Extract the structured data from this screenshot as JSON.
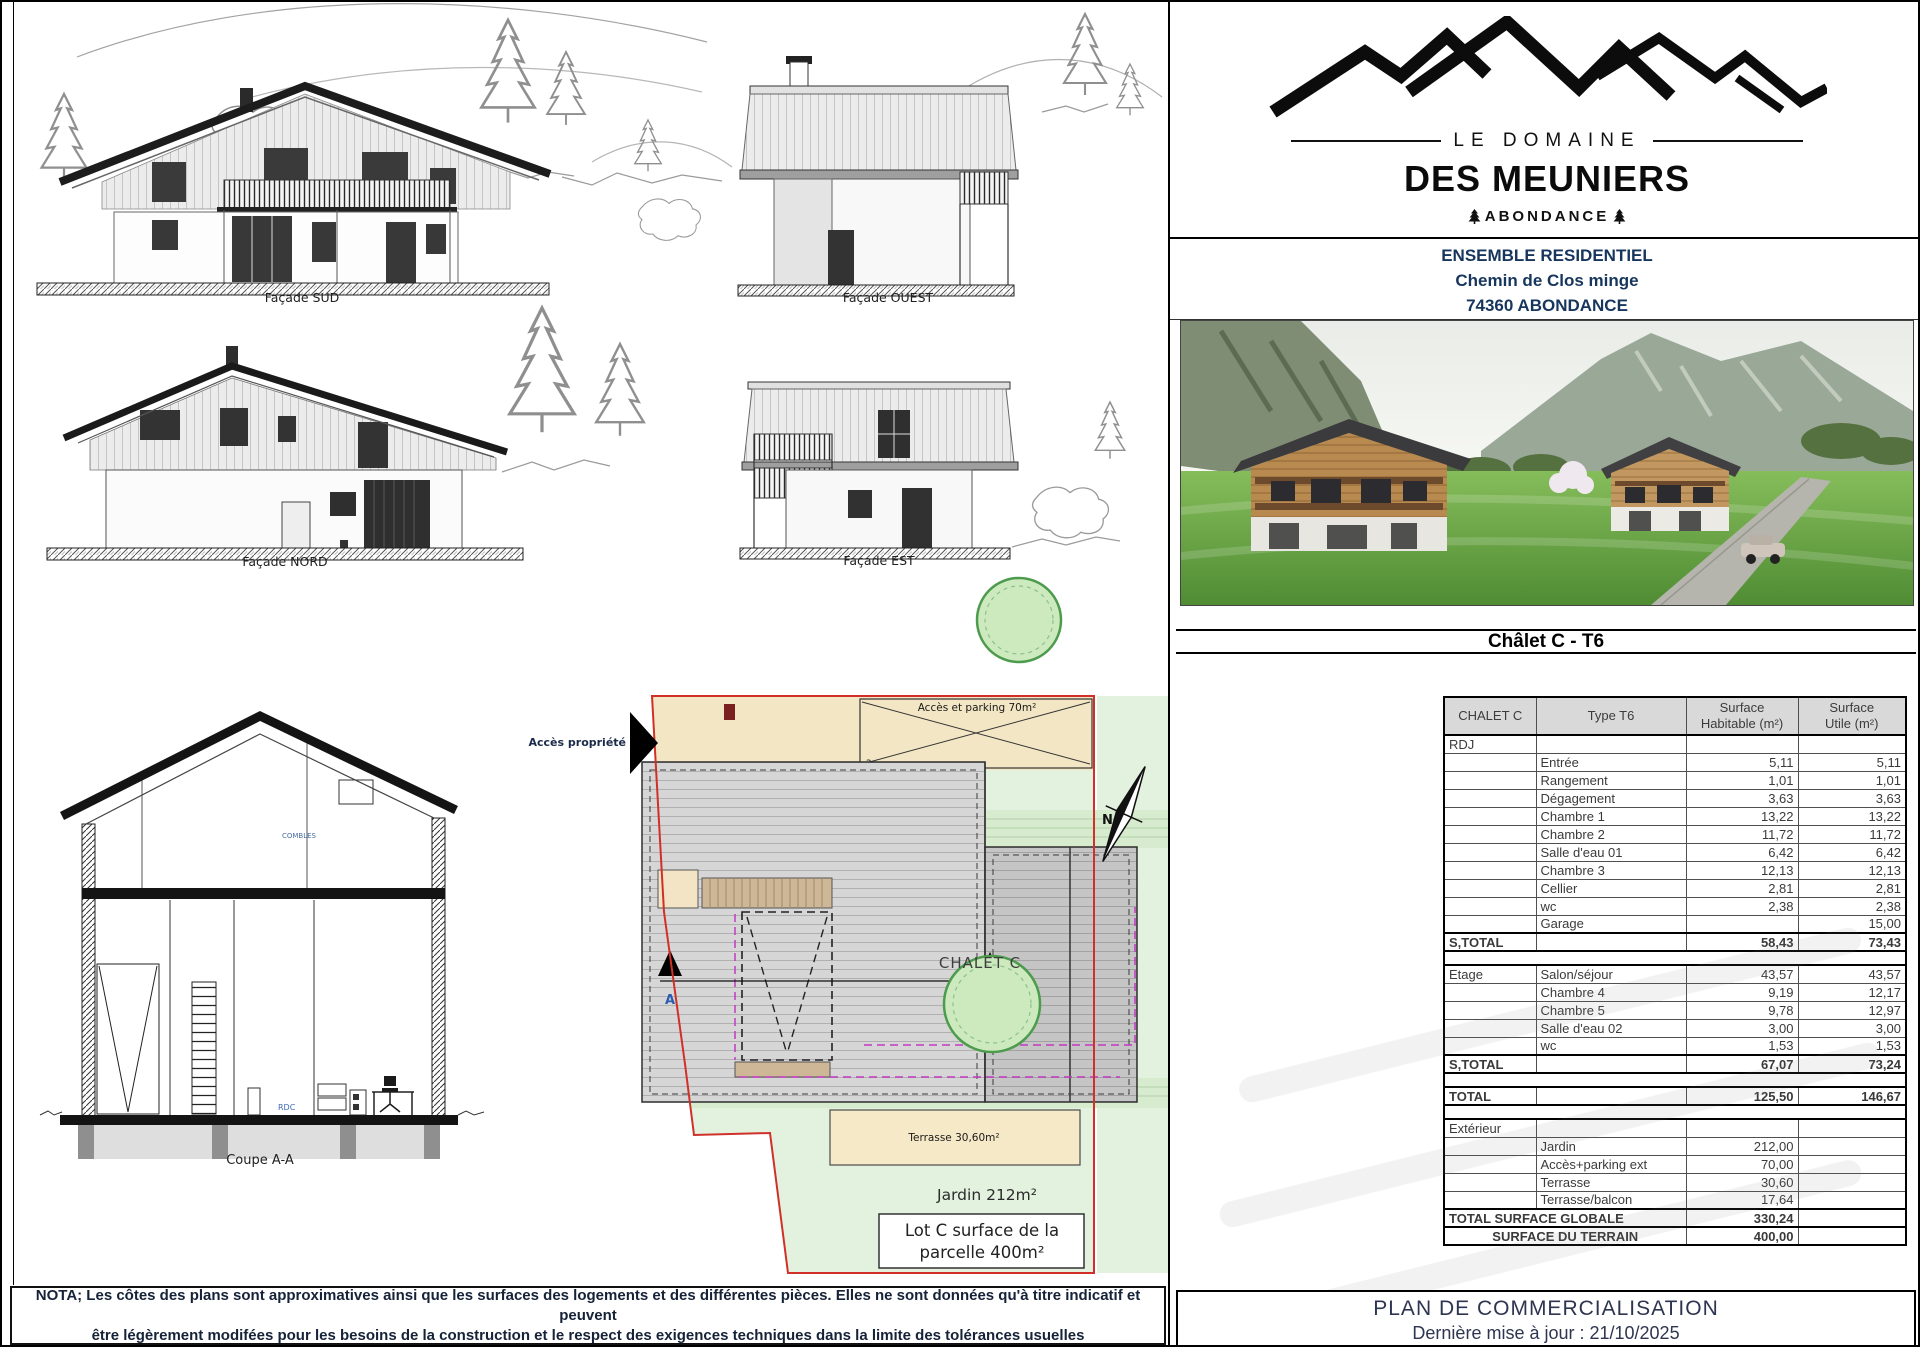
{
  "page": {
    "nota_line1": "NOTA; Les côtes des plans sont approximatives ainsi que les surfaces des logements et des différentes pièces. Elles ne sont données qu'à titre indicatif et peuvent",
    "nota_line2": "être légèrement modifées pour les besoins de la construction et le respect des exigences techniques dans la limite des tolérances usuelles"
  },
  "drawings": {
    "facade_sud_label": "Façade SUD",
    "facade_ouest_label": "Façade OUEST",
    "facade_nord_label": "Façade NORD",
    "facade_est_label": "Façade EST",
    "coupe_label": "Coupe A-A",
    "combles_label": "COMBLES",
    "rdc_label": "RDC"
  },
  "siteplan": {
    "chalet_label": "CHALET C",
    "acces_parking_label": "Accès et parking 70m²",
    "acces_propriete_label": "Accès propriété",
    "terrasse_label": "Terrasse 30,60m²",
    "jardin_label": "Jardin 212m²",
    "lot_line1": "Lot C surface de la",
    "lot_line2": "parcelle 400m²",
    "section_marker_left": "A",
    "section_marker_right": "A",
    "parking_number": "2",
    "north_label": "N"
  },
  "panel": {
    "brand": {
      "top": "LE DOMAINE",
      "name": "DES MEUNIERS",
      "location": "ABONDANCE"
    },
    "address": {
      "line1": "ENSEMBLE RESIDENTIEL",
      "line2": "Chemin de Clos minge",
      "line3": "74360 ABONDANCE"
    },
    "unit_title": "Châlet C - T6",
    "table": {
      "headers": {
        "col1": "CHALET C",
        "col2": "Type T6",
        "col3": "Surface\nHabitable (m²)",
        "col4": "Surface\nUtile (m²)"
      },
      "rows": [
        {
          "type": "section",
          "c1": "RDJ",
          "c2": "",
          "hab": "",
          "utile": ""
        },
        {
          "type": "row",
          "c1": "",
          "c2": "Entrée",
          "hab": "5,11",
          "utile": "5,11"
        },
        {
          "type": "row",
          "c1": "",
          "c2": "Rangement",
          "hab": "1,01",
          "utile": "1,01"
        },
        {
          "type": "row",
          "c1": "",
          "c2": "Dégagement",
          "hab": "3,63",
          "utile": "3,63"
        },
        {
          "type": "row",
          "c1": "",
          "c2": "Chambre 1",
          "hab": "13,22",
          "utile": "13,22"
        },
        {
          "type": "row",
          "c1": "",
          "c2": "Chambre 2",
          "hab": "11,72",
          "utile": "11,72"
        },
        {
          "type": "row",
          "c1": "",
          "c2": "Salle d'eau 01",
          "hab": "6,42",
          "utile": "6,42"
        },
        {
          "type": "row",
          "c1": "",
          "c2": "Chambre 3",
          "hab": "12,13",
          "utile": "12,13"
        },
        {
          "type": "row",
          "c1": "",
          "c2": "Cellier",
          "hab": "2,81",
          "utile": "2,81"
        },
        {
          "type": "row",
          "c1": "",
          "c2": "wc",
          "hab": "2,38",
          "utile": "2,38"
        },
        {
          "type": "row",
          "c1": "",
          "c2": "Garage",
          "hab": "",
          "utile": "15,00"
        },
        {
          "type": "subtotal",
          "c1": "S,TOTAL",
          "c2": "",
          "hab": "58,43",
          "utile": "73,43"
        },
        {
          "type": "gap"
        },
        {
          "type": "row2",
          "c1": "Etage",
          "c2": "Salon/séjour",
          "hab": "43,57",
          "utile": "43,57"
        },
        {
          "type": "row",
          "c1": "",
          "c2": "Chambre 4",
          "hab": "9,19",
          "utile": "12,17"
        },
        {
          "type": "row",
          "c1": "",
          "c2": "Chambre 5",
          "hab": "9,78",
          "utile": "12,97"
        },
        {
          "type": "row",
          "c1": "",
          "c2": "Salle d'eau 02",
          "hab": "3,00",
          "utile": "3,00"
        },
        {
          "type": "row",
          "c1": "",
          "c2": "wc",
          "hab": "1,53",
          "utile": "1,53"
        },
        {
          "type": "subtotal",
          "c1": "S,TOTAL",
          "c2": "",
          "hab": "67,07",
          "utile": "73,24"
        },
        {
          "type": "gap"
        },
        {
          "type": "subtotal",
          "c1": "TOTAL",
          "c2": "",
          "hab": "125,50",
          "utile": "146,67"
        },
        {
          "type": "gap"
        },
        {
          "type": "section",
          "c1": "Extérieur",
          "c2": "",
          "hab": "",
          "utile": ""
        },
        {
          "type": "row",
          "c1": "",
          "c2": "Jardin",
          "hab": "212,00",
          "utile": ""
        },
        {
          "type": "row",
          "c1": "",
          "c2": "Accès+parking ext",
          "hab": "70,00",
          "utile": ""
        },
        {
          "type": "row",
          "c1": "",
          "c2": "Terrasse",
          "hab": "30,60",
          "utile": ""
        },
        {
          "type": "row",
          "c1": "",
          "c2": "Terrasse/balcon",
          "hab": "17,64",
          "utile": ""
        },
        {
          "type": "grand",
          "align": "left",
          "c1": "TOTAL SURFACE GLOBALE",
          "hab": "330,24",
          "utile": ""
        },
        {
          "type": "grand",
          "align": "center",
          "c1": "SURFACE DU TERRAIN",
          "hab": "400,00",
          "utile": ""
        }
      ]
    },
    "footer": {
      "title": "PLAN DE COMMERCIALISATION",
      "updated": "Dernière mise à jour : 21/10/2025"
    }
  }
}
